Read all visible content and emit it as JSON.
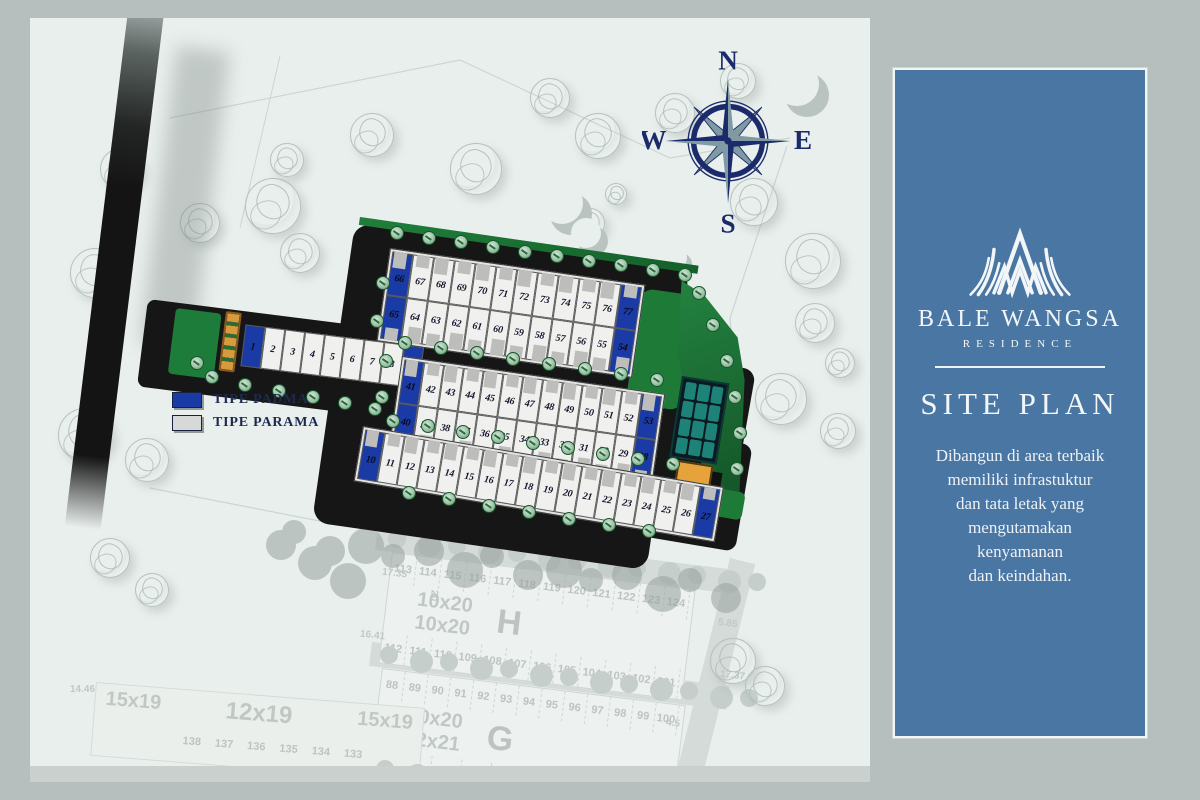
{
  "panel": {
    "brand": "BALE WANGSA",
    "brand_sub": "RESIDENCE",
    "heading": "SITE PLAN",
    "description_lines": [
      "Dibangun di area terbaik",
      "memiliki infrastuktur",
      "dan tata letak yang",
      "mengutamakan",
      "kenyamanan",
      "dan keindahan."
    ]
  },
  "compass": {
    "north": "N",
    "east": "E",
    "south": "S",
    "west": "W"
  },
  "legend": {
    "items": [
      {
        "label": "TIPE PADMA",
        "type": "padma"
      },
      {
        "label": "TIPE PARAMA",
        "type": "parama"
      }
    ]
  },
  "site": {
    "blockA_north": [
      {
        "n": "66",
        "t": "padma"
      },
      {
        "n": "67",
        "t": "parama"
      },
      {
        "n": "68",
        "t": "parama"
      },
      {
        "n": "69",
        "t": "parama"
      },
      {
        "n": "70",
        "t": "parama"
      },
      {
        "n": "71",
        "t": "parama"
      },
      {
        "n": "72",
        "t": "parama"
      },
      {
        "n": "73",
        "t": "parama"
      },
      {
        "n": "74",
        "t": "parama"
      },
      {
        "n": "75",
        "t": "parama"
      },
      {
        "n": "76",
        "t": "parama"
      },
      {
        "n": "77",
        "t": "padma"
      }
    ],
    "blockA_south": [
      {
        "n": "65",
        "t": "padma"
      },
      {
        "n": "64",
        "t": "parama"
      },
      {
        "n": "63",
        "t": "parama"
      },
      {
        "n": "62",
        "t": "parama"
      },
      {
        "n": "61",
        "t": "parama"
      },
      {
        "n": "60",
        "t": "parama"
      },
      {
        "n": "59",
        "t": "parama"
      },
      {
        "n": "58",
        "t": "parama"
      },
      {
        "n": "57",
        "t": "parama"
      },
      {
        "n": "56",
        "t": "parama"
      },
      {
        "n": "55",
        "t": "parama"
      },
      {
        "n": "54",
        "t": "padma"
      }
    ],
    "blockB_north": [
      {
        "n": "41",
        "t": "padma"
      },
      {
        "n": "42",
        "t": "parama"
      },
      {
        "n": "43",
        "t": "parama"
      },
      {
        "n": "44",
        "t": "parama"
      },
      {
        "n": "45",
        "t": "parama"
      },
      {
        "n": "46",
        "t": "parama"
      },
      {
        "n": "47",
        "t": "parama"
      },
      {
        "n": "48",
        "t": "parama"
      },
      {
        "n": "49",
        "t": "parama"
      },
      {
        "n": "50",
        "t": "parama"
      },
      {
        "n": "51",
        "t": "parama"
      },
      {
        "n": "52",
        "t": "parama"
      },
      {
        "n": "53",
        "t": "padma"
      }
    ],
    "blockB_south": [
      {
        "n": "40",
        "t": "padma"
      },
      {
        "n": "39",
        "t": "parama"
      },
      {
        "n": "38",
        "t": "parama"
      },
      {
        "n": "37",
        "t": "parama"
      },
      {
        "n": "36",
        "t": "parama"
      },
      {
        "n": "35",
        "t": "parama"
      },
      {
        "n": "34",
        "t": "parama"
      },
      {
        "n": "33",
        "t": "parama"
      },
      {
        "n": "32",
        "t": "parama"
      },
      {
        "n": "31",
        "t": "parama"
      },
      {
        "n": "30",
        "t": "parama"
      },
      {
        "n": "29",
        "t": "parama"
      },
      {
        "n": "28",
        "t": "padma"
      }
    ],
    "rowC": [
      {
        "n": "10",
        "t": "padma"
      },
      {
        "n": "11",
        "t": "parama"
      },
      {
        "n": "12",
        "t": "parama"
      },
      {
        "n": "13",
        "t": "parama"
      },
      {
        "n": "14",
        "t": "parama"
      },
      {
        "n": "15",
        "t": "parama"
      },
      {
        "n": "16",
        "t": "parama"
      },
      {
        "n": "17",
        "t": "parama"
      },
      {
        "n": "18",
        "t": "parama"
      },
      {
        "n": "19",
        "t": "parama"
      },
      {
        "n": "20",
        "t": "parama"
      },
      {
        "n": "21",
        "t": "parama"
      },
      {
        "n": "22",
        "t": "parama"
      },
      {
        "n": "23",
        "t": "parama"
      },
      {
        "n": "24",
        "t": "parama"
      },
      {
        "n": "25",
        "t": "parama"
      },
      {
        "n": "26",
        "t": "parama"
      },
      {
        "n": "27",
        "t": "padma"
      }
    ],
    "strip": [
      {
        "n": "1",
        "t": "padma"
      },
      {
        "n": "2",
        "t": "parama"
      },
      {
        "n": "3",
        "t": "parama"
      },
      {
        "n": "4",
        "t": "parama"
      },
      {
        "n": "5",
        "t": "parama"
      },
      {
        "n": "6",
        "t": "parama"
      },
      {
        "n": "7",
        "t": "parama"
      },
      {
        "n": "8",
        "t": "parama"
      },
      {
        "n": "9",
        "t": "padma"
      }
    ]
  },
  "phase2": {
    "blockH": {
      "top": [
        "113",
        "114",
        "115",
        "116",
        "117",
        "118",
        "119",
        "120",
        "121",
        "122",
        "123",
        "124"
      ],
      "bottom": [
        "112",
        "111",
        "110",
        "109",
        "108",
        "107",
        "106",
        "105",
        "104",
        "103",
        "102",
        "101"
      ],
      "size_labels": [
        "10x20",
        "10x20"
      ],
      "block_letter": "H"
    },
    "blockG": {
      "top": [
        "88",
        "89",
        "90",
        "91",
        "92",
        "93",
        "94",
        "95",
        "96",
        "97",
        "98",
        "99",
        "100"
      ],
      "bottom": [
        "87",
        "86",
        "85",
        "84",
        "83",
        "82",
        "81",
        "80",
        "79",
        "78"
      ],
      "size_labels": [
        "10x20",
        "12x21"
      ],
      "block_letter": "G"
    },
    "west_row": {
      "size_labels": [
        "15x19",
        "12x19",
        "15x19"
      ],
      "numbers": [
        "138",
        "137",
        "136",
        "135",
        "134",
        "133"
      ]
    },
    "dims": [
      "17.35",
      "16.41",
      "20",
      "5.85",
      "17.37",
      "14.46",
      "4.5"
    ]
  },
  "colors": {
    "panel": "#4a76a3",
    "frame": "#b7bebe",
    "map_bg": "#e9efec",
    "padma": "#1a3aa6",
    "parama": "#d7d9d8",
    "road": "#161616",
    "green": "#1d7a37",
    "garden_teal": "#1f8f82",
    "facility_orange": "#e6a33c",
    "navy": "#1b2a6b",
    "compass_steel": "#7f9aa3"
  }
}
